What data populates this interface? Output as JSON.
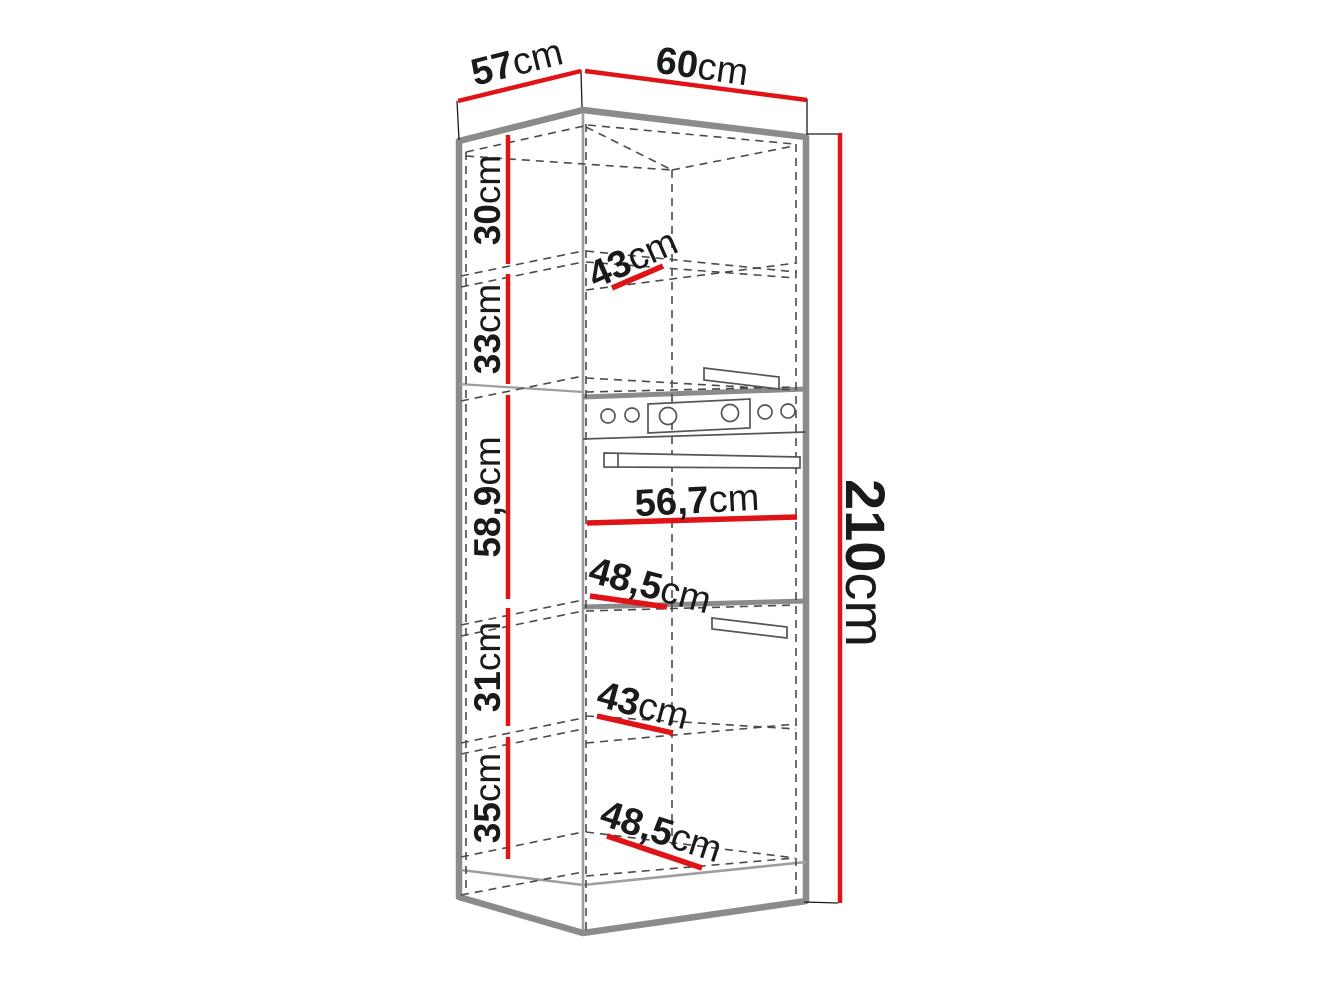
{
  "diagram": {
    "overall": {
      "depth": {
        "value": "57",
        "unit": "cm"
      },
      "width": {
        "value": "60",
        "unit": "cm"
      },
      "height": {
        "value": "210",
        "unit": "cm"
      }
    },
    "left_sections": [
      {
        "value": "30",
        "unit": "cm"
      },
      {
        "value": "33",
        "unit": "cm"
      },
      {
        "value": "58,9",
        "unit": "cm"
      },
      {
        "value": "31",
        "unit": "cm"
      },
      {
        "value": "35",
        "unit": "cm"
      }
    ],
    "interior_widths": [
      {
        "value": "43",
        "unit": "cm"
      },
      {
        "value": "56,7",
        "unit": "cm"
      },
      {
        "value": "48,5",
        "unit": "cm"
      },
      {
        "value": "43",
        "unit": "cm"
      },
      {
        "value": "48,5",
        "unit": "cm"
      }
    ],
    "colors": {
      "dimension_red": "#e01317",
      "outline_gray": "#8b8b8b",
      "edge_gray": "#9e9e9e",
      "dashed_gray": "#4a4a4a",
      "label_black": "#1a1a1a",
      "background": "#ffffff"
    }
  }
}
